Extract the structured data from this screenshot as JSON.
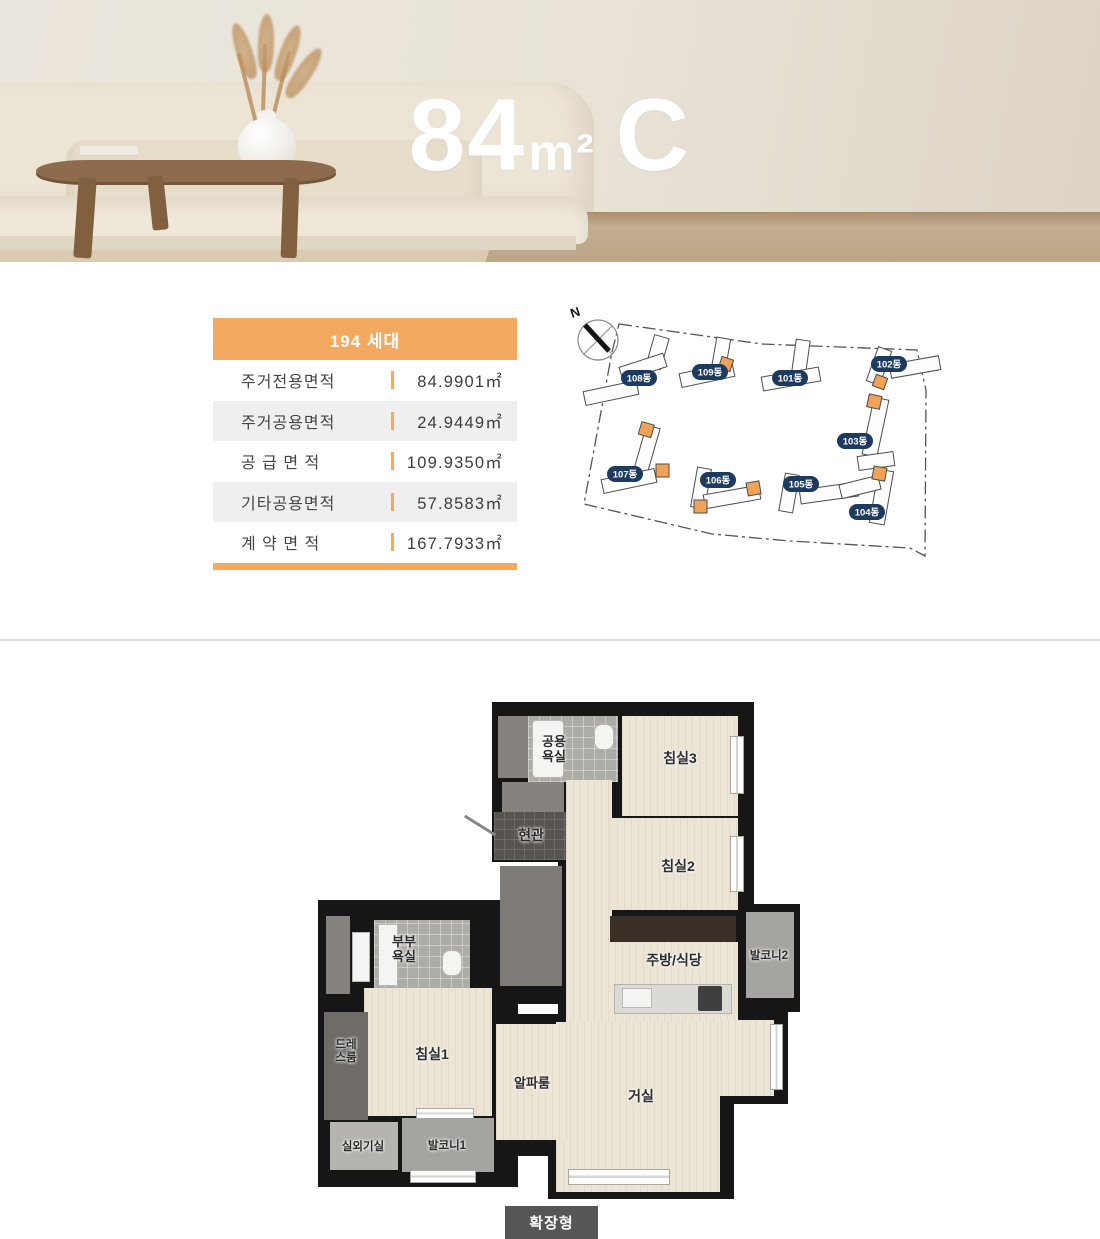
{
  "hero": {
    "title": {
      "number": "84",
      "unit": "m²",
      "type": "C"
    }
  },
  "info_table": {
    "header": "194 세대",
    "accent_color": "#F3A95F",
    "rows": [
      {
        "label": "주거전용면적",
        "value": "84.9901㎡"
      },
      {
        "label": "주거공용면적",
        "value": "24.9449㎡"
      },
      {
        "label": "공 급 면 적",
        "value": "109.9350㎡"
      },
      {
        "label": "기타공용면적",
        "value": "57.8583㎡"
      },
      {
        "label": "계 약 면 적",
        "value": "167.7933㎡"
      }
    ]
  },
  "site_map": {
    "compass_label": "N",
    "highlight_color": "#F0A356",
    "pill_color": "#1D3A5F",
    "buildings": [
      {
        "label": "108동"
      },
      {
        "label": "109동"
      },
      {
        "label": "101동"
      },
      {
        "label": "102동"
      },
      {
        "label": "103동"
      },
      {
        "label": "107동"
      },
      {
        "label": "106동"
      },
      {
        "label": "105동"
      },
      {
        "label": "104동"
      }
    ]
  },
  "floor_plan": {
    "rooms": {
      "common_bath": "공용욕실",
      "bedroom3": "침실3",
      "entrance": "현관",
      "bedroom2": "침실2",
      "master_bath": "부부욕실",
      "kitchen": "주방/식당",
      "balcony2": "발코니2",
      "dress_room": "드레스룸",
      "bedroom1": "침실1",
      "alpha_room": "알파룸",
      "living_room": "거실",
      "outdoor_unit": "실외기실",
      "balcony1": "발코니1"
    }
  },
  "footer": {
    "button_label": "확장형"
  }
}
